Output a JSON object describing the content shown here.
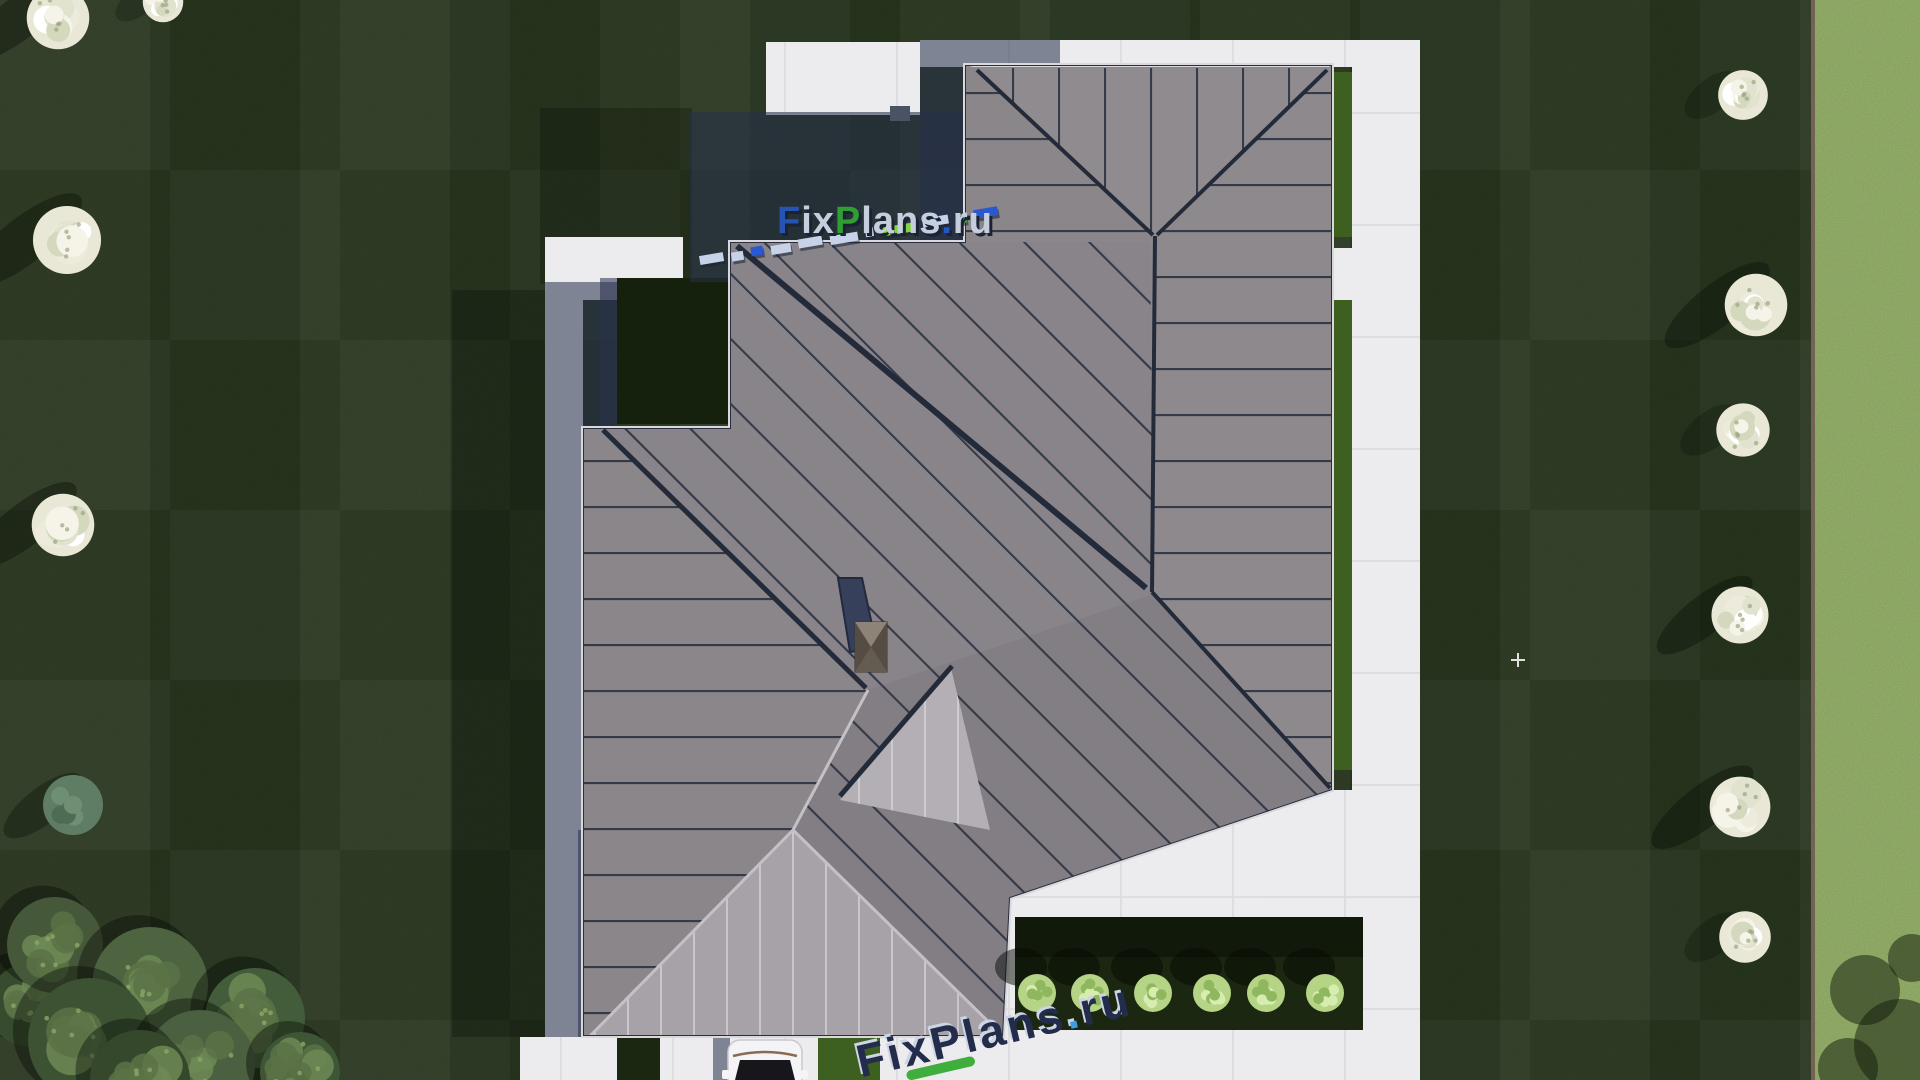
{
  "palette": {
    "lawn_dark": "#2b3a21",
    "lawn_patch": "#24331c",
    "lawn_light_strip": "#a3c074",
    "strip_border": "#87725f",
    "path": "#ececee",
    "path_joint": "#dcdce0",
    "roof_base": "#8b868a",
    "roof_north": "#908b8f",
    "roof_east": "#8e898d",
    "roof_central": "#89848a",
    "roof_west": "#8b8689",
    "roof_se": "#837e84",
    "roof_porch": "#a7a2a8",
    "roof_light_face": "#b4afb5",
    "seam_dark": "#252d3d",
    "seam_light": "#d8d4da",
    "fascia": "#d9d9dd",
    "shadow_navy": "rgba(38,47,76,0.55)",
    "courtyard": "#16210d",
    "hedge": "#3d6020",
    "bed": "#1b2711",
    "bush": "#b5d485",
    "skylight": "#36405a",
    "chimney": "#786f62",
    "car_body": "#f4f4f6",
    "car_glass": "#16161b"
  },
  "watermark_top": {
    "full_text": "FixPlans.ru",
    "shadow_color": "#1a2233",
    "letters": [
      {
        "t": "F",
        "c": "#2753b2"
      },
      {
        "t": "i",
        "c": "#c6cede"
      },
      {
        "t": "x",
        "c": "#c6cede"
      },
      {
        "t": "P",
        "c": "#2f9e33"
      },
      {
        "t": "l",
        "c": "#c6cede"
      },
      {
        "t": "a",
        "c": "#c6cede"
      },
      {
        "t": "n",
        "c": "#c6cede"
      },
      {
        "t": "s",
        "c": "#c6cede"
      },
      {
        "t": ".",
        "c": "#2257c8"
      },
      {
        "t": "r",
        "c": "#c6cede"
      },
      {
        "t": "u",
        "c": "#c6cede"
      }
    ],
    "dashes": [
      {
        "w": 24,
        "c": "#c7d2e8"
      },
      {
        "w": 12,
        "c": "#c7d2e8"
      },
      {
        "w": 12,
        "c": "#2a58d0"
      },
      {
        "w": 20,
        "c": "#c7d2e8"
      },
      {
        "w": 24,
        "c": "#c7d2e8"
      },
      {
        "w": 28,
        "c": "#c7d2e8"
      },
      {
        "w": 8,
        "c": "#c7d2e8"
      },
      {
        "w": 34,
        "c": "#7ed63a"
      },
      {
        "w": 26,
        "c": "#c7d2e8"
      },
      {
        "w": 10,
        "c": "#3fae3c"
      },
      {
        "w": 24,
        "c": "#2a58d0"
      }
    ]
  },
  "watermark_bottom": {
    "full_text": "FixPlans.ru",
    "letter_color": "#232d4b",
    "dot_color": "#3aa0dc",
    "swoosh_color": "#3fae3c",
    "highlight_color": "#cdd4e2",
    "letters": [
      {
        "t": "F",
        "c": "#232d4b"
      },
      {
        "t": "i",
        "c": "#232d4b"
      },
      {
        "t": "x",
        "c": "#232d4b"
      },
      {
        "t": "P",
        "c": "#232d4b"
      },
      {
        "t": "l",
        "c": "#232d4b"
      },
      {
        "t": "a",
        "c": "#232d4b"
      },
      {
        "t": "n",
        "c": "#232d4b"
      },
      {
        "t": "s",
        "c": "#232d4b"
      },
      {
        "t": ".",
        "c": "#3aa0dc"
      },
      {
        "t": "r",
        "c": "#232d4b"
      },
      {
        "t": "u",
        "c": "#232d4b"
      }
    ]
  },
  "vegetation": {
    "white_trees": [
      {
        "x": 58,
        "y": 18,
        "r": 34,
        "streak": 1
      },
      {
        "x": 163,
        "y": 2,
        "r": 22,
        "streak": 0
      },
      {
        "x": 67,
        "y": 240,
        "r": 37,
        "streak": 1
      },
      {
        "x": 63,
        "y": 525,
        "r": 34,
        "streak": 1
      },
      {
        "x": 1743,
        "y": 95,
        "r": 27,
        "streak": 0
      },
      {
        "x": 1756,
        "y": 305,
        "r": 34,
        "streak": 1
      },
      {
        "x": 1743,
        "y": 430,
        "r": 29,
        "streak": 0
      },
      {
        "x": 1740,
        "y": 615,
        "r": 31,
        "streak": 1
      },
      {
        "x": 1740,
        "y": 807,
        "r": 33,
        "streak": 1
      },
      {
        "x": 1745,
        "y": 937,
        "r": 28,
        "streak": 0
      }
    ],
    "accent_tree": {
      "x": 73,
      "y": 805,
      "r": 30,
      "c": "#5e7d64"
    },
    "green_trees": [
      {
        "x": 30,
        "y": 1005,
        "r": 42,
        "c": "#374b2e"
      },
      {
        "x": 55,
        "y": 945,
        "r": 48,
        "c": "#46583a"
      },
      {
        "x": 150,
        "y": 985,
        "r": 58,
        "c": "#4e6340"
      },
      {
        "x": 255,
        "y": 1018,
        "r": 50,
        "c": "#435d3a"
      },
      {
        "x": 90,
        "y": 1040,
        "r": 62,
        "c": "#3c5233"
      },
      {
        "x": 200,
        "y": 1065,
        "r": 55,
        "c": "#4a6040"
      },
      {
        "x": 300,
        "y": 1072,
        "r": 40,
        "c": "#3f5636"
      },
      {
        "x": 140,
        "y": 1080,
        "r": 50,
        "c": "#35482c"
      }
    ],
    "bushes": {
      "y": 993,
      "r": 19,
      "xs": [
        1037,
        1090,
        1153,
        1212,
        1266,
        1325
      ]
    },
    "corner_shadow_blobs": [
      {
        "x": 1865,
        "y": 990,
        "r": 35
      },
      {
        "x": 1900,
        "y": 1045,
        "r": 46
      },
      {
        "x": 1848,
        "y": 1068,
        "r": 30
      },
      {
        "x": 1912,
        "y": 958,
        "r": 24
      }
    ]
  },
  "sparkle": {
    "x": 1518,
    "y": 660
  }
}
